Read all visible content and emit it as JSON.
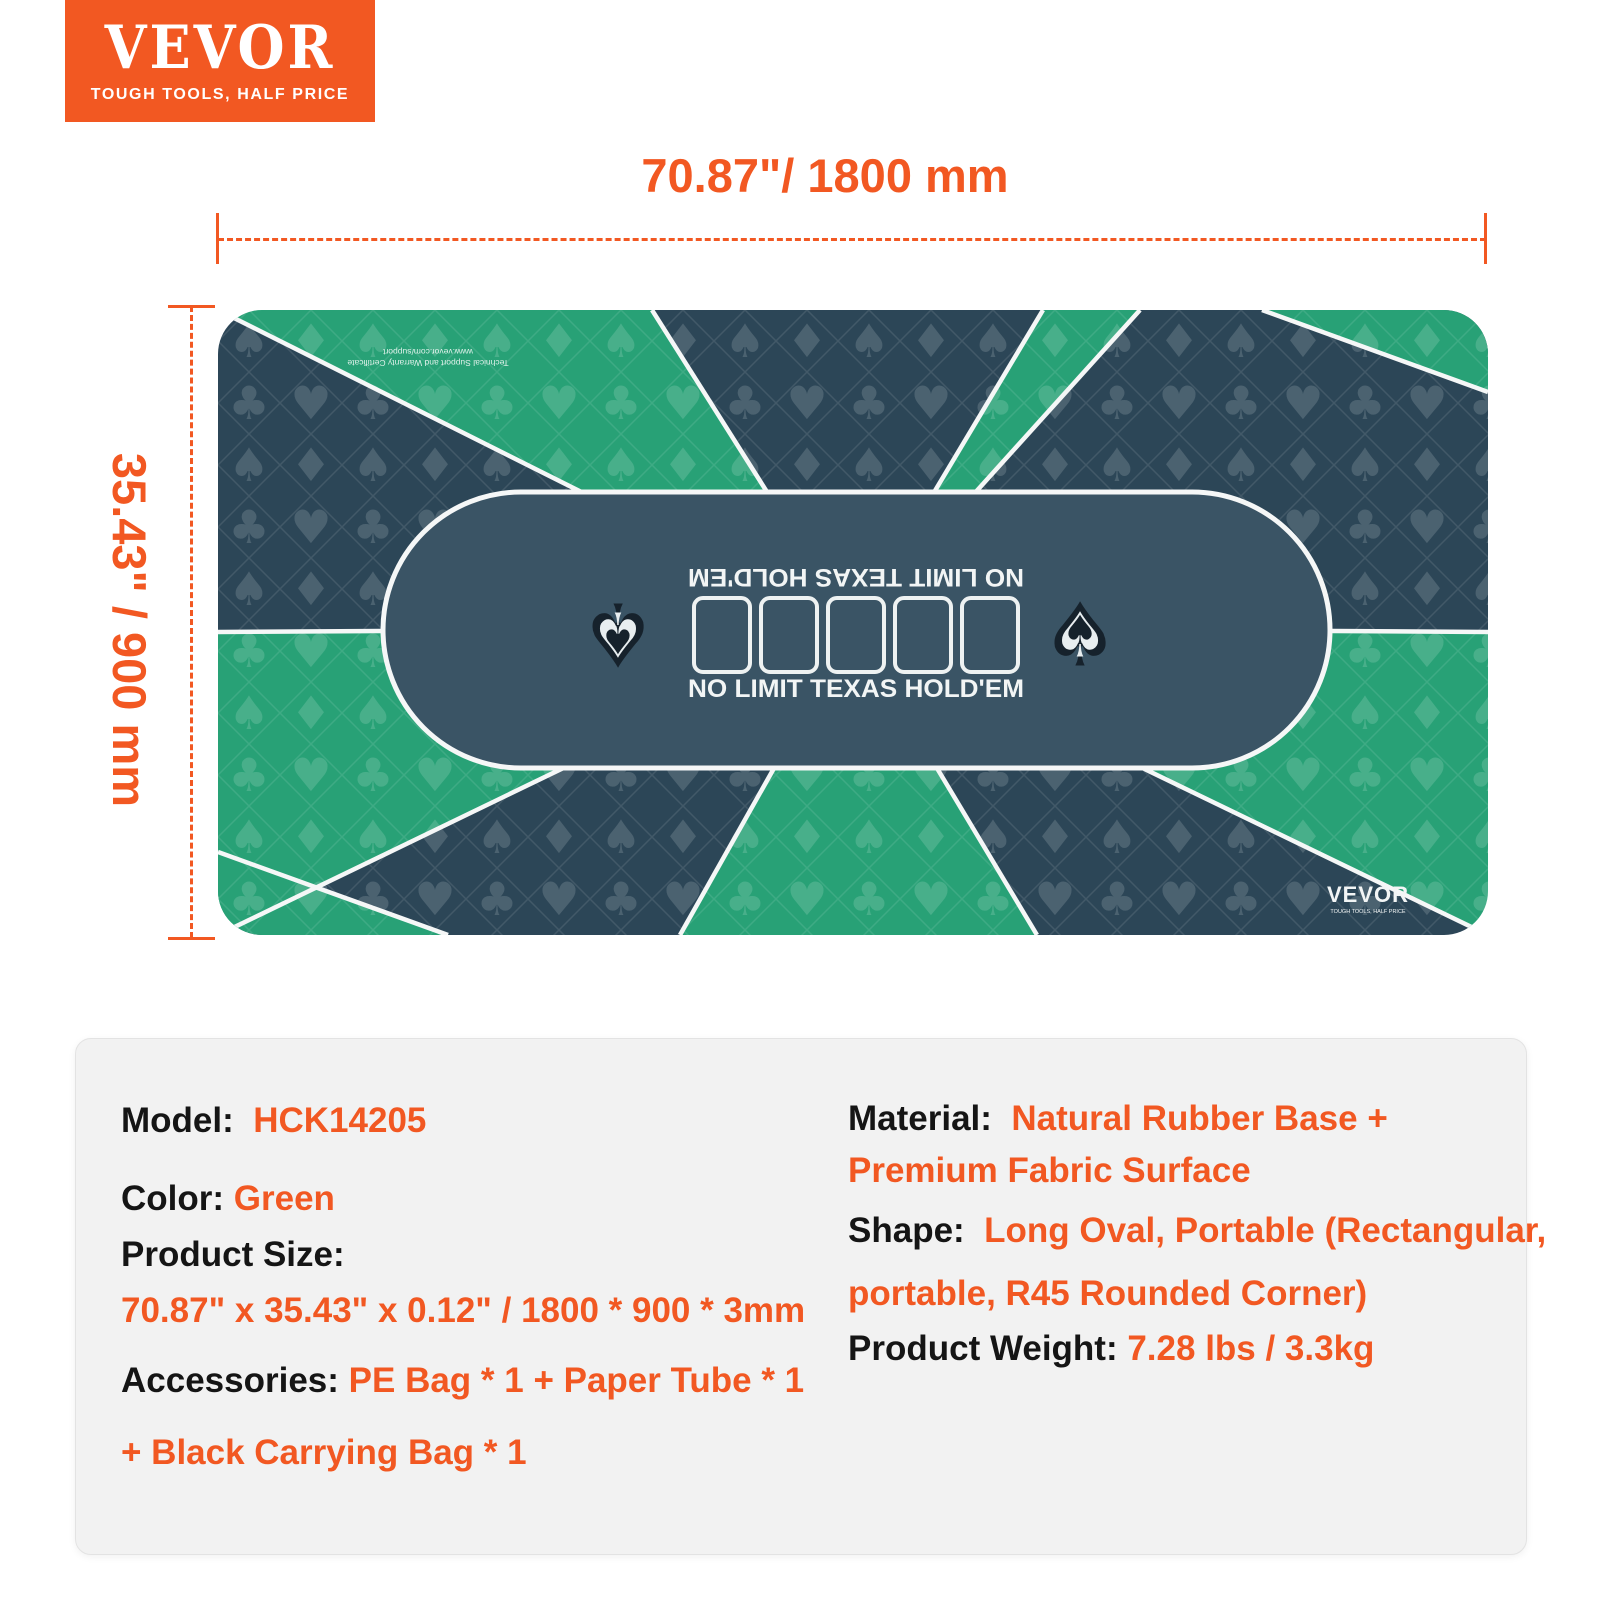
{
  "brand": {
    "logo_text": "VEVOR",
    "tagline": "TOUGH TOOLS, HALF PRICE"
  },
  "dimensions": {
    "width_label": "70.87\"/ 1800 mm",
    "height_label": "35.43\" / 900 mm"
  },
  "mat": {
    "center_text_top": "NO LIMIT TEXAS HOLD'EM",
    "center_text_bottom": "NO LIMIT TEXAS HOLD'EM",
    "corner_note_line1": "Technical Support and Warranty Certificate",
    "corner_note_line2": "www.vevor.com/support",
    "mat_logo_text": "VEVOR",
    "mat_logo_tagline": "TOUGH TOOLS, HALF PRICE",
    "card_slot_count": 5,
    "colors": {
      "green": "#28a176",
      "dark": "#2c4657",
      "oval": "#3a5465",
      "line": "#f5f7f7",
      "orange": "#f25822"
    }
  },
  "icons": {
    "spade": "♠",
    "heart": "♥",
    "diamond": "♦",
    "club": "♣"
  },
  "specs": {
    "left": [
      {
        "label": "Model:",
        "value": "HCK14205"
      },
      {
        "label": "Color:",
        "value": "Green"
      },
      {
        "label": "Product Size:",
        "value": ""
      },
      {
        "label": "",
        "value": "70.87\" x 35.43\" x 0.12\" / 1800 * 900 * 3mm"
      },
      {
        "label": "Accessories:",
        "value": "PE Bag * 1 + Paper Tube * 1"
      },
      {
        "label": "",
        "value": "+ Black Carrying Bag * 1"
      }
    ],
    "right": [
      {
        "label": "Material:",
        "value": "Natural Rubber Base +"
      },
      {
        "label": "",
        "value": "Premium Fabric Surface"
      },
      {
        "label": "Shape:",
        "value": "Long Oval, Portable (Rectangular,"
      },
      {
        "label": "",
        "value": "portable, R45 Rounded Corner)"
      },
      {
        "label": "Product Weight:",
        "value": "7.28 lbs / 3.3kg"
      }
    ]
  }
}
